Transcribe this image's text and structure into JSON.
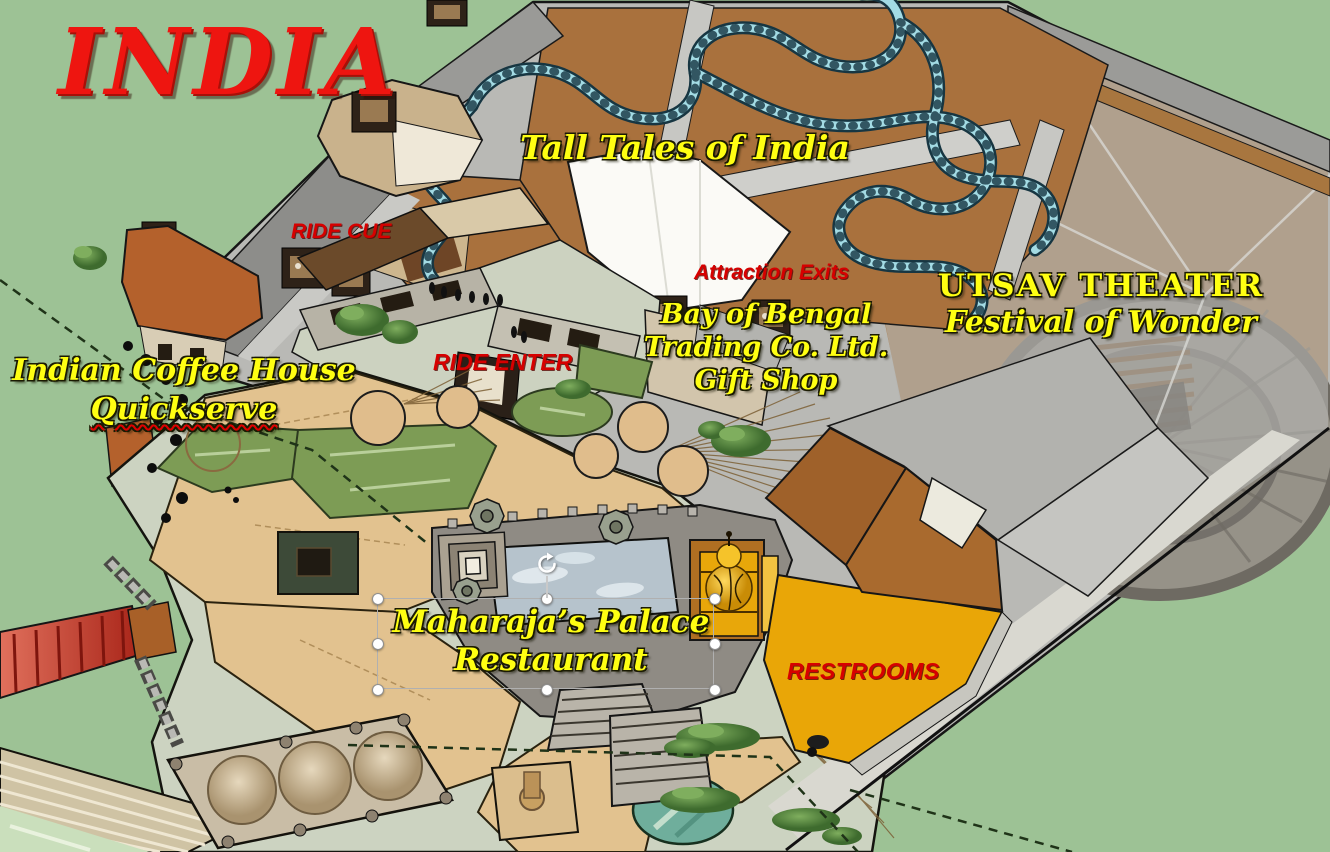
{
  "slide": {
    "title": "INDIA",
    "labels": {
      "attraction_name": "Tall Tales of India",
      "ride_queue": "RIDE CUE",
      "ride_entrance": "RIDE ENTER",
      "attraction_exits": "Attraction Exits",
      "gift_shop": {
        "line1": "Bay of Bengal",
        "line2": "Trading Co. Ltd.",
        "line3": "Gift Shop"
      },
      "theater": {
        "line1": "UTSAV THEATER",
        "line2": "Festival of Wonder"
      },
      "coffee_house": {
        "line1": "Indian Coffee House",
        "line2": "Quickserve"
      },
      "restaurant": {
        "line1": "Maharaja’s Palace",
        "line2": "Restaurant"
      },
      "restrooms": "RESTROOMS"
    },
    "selection": {
      "selected_object": "restaurant-label",
      "handle_count": 8,
      "has_rotate_handle": true,
      "spellcheck_underline_word": "Quickserve"
    },
    "map_features": [
      "show-building-tall-tales-dark-ride",
      "water-flume-track",
      "utsav-theater-circular-arena",
      "gift-shop-building",
      "indian-coffee-house-building",
      "maharajas-palace-restaurant",
      "palace-reflecting-pool",
      "gold-dome-tower",
      "restrooms-gold-plaza",
      "guest-plaza-shade-canopies",
      "lawns",
      "red-entry-bridge",
      "bathing-ghats-steps",
      "triple-dome-pavilion",
      "pond",
      "trees"
    ],
    "colors": {
      "background_green": "#9dc295",
      "title_red": "#ee1510",
      "label_yellow": "#ffff12",
      "label_red": "#d60000",
      "flume_teal": "#a3dbe4",
      "plaza_tan": "#e2c28f",
      "concrete_sage": "#ccd3c1",
      "lawn_green": "#7d9c55",
      "roof_gray": "#b5b5b1",
      "wall_brown": "#a9713d",
      "coffee_house_orange": "#b4612c",
      "gold_plaza": "#e9a607",
      "gold_dome": "#f2b705",
      "pool_blue": "#b6c3cc",
      "bridge_red": "#c23a28"
    }
  }
}
